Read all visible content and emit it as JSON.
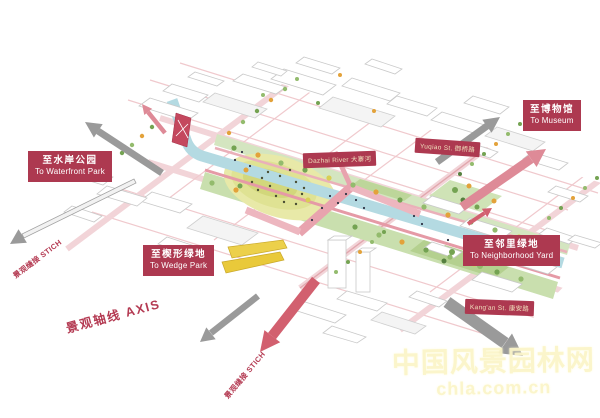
{
  "destinations": {
    "waterfront": {
      "cn": "至水岸公园",
      "en": "To Waterfront Park"
    },
    "museum": {
      "cn": "至博物馆",
      "en": "To Museum"
    },
    "wedge": {
      "cn": "至楔形绿地",
      "en": "To Wedge Park"
    },
    "neighborhood": {
      "cn": "至邻里绿地",
      "en": "To Neighborhood Yard"
    }
  },
  "streets": {
    "dazhai_river": "Dazhai River  大寨河",
    "yuqiao_st": "Yuqiao St.  御桥路",
    "kangan_st": "Kang'an St.  康安路"
  },
  "axis": {
    "stitch_left": "景观缝接 STICH",
    "axis_main": "景观轴线 AXIS",
    "stitch_bottom": "景观缝接 STICH"
  },
  "watermark": {
    "site_name": "中国风景园林网",
    "site_url": "chla.com.cn"
  },
  "colors": {
    "label_bg": "#ad3950",
    "axis_text": "#b43a52",
    "pink_arrow": "#d2606f",
    "pink_arrow_light": "#de8a97",
    "gray_arrow": "#9a9a9a",
    "river": "#b4dae2",
    "park_green": "#c9dfae",
    "hill_yellow": "#e8e9a8",
    "wedge_yellow": "#e9c93a",
    "road_pink": "#f0c9cd",
    "watermark": "#fbf5c9"
  }
}
